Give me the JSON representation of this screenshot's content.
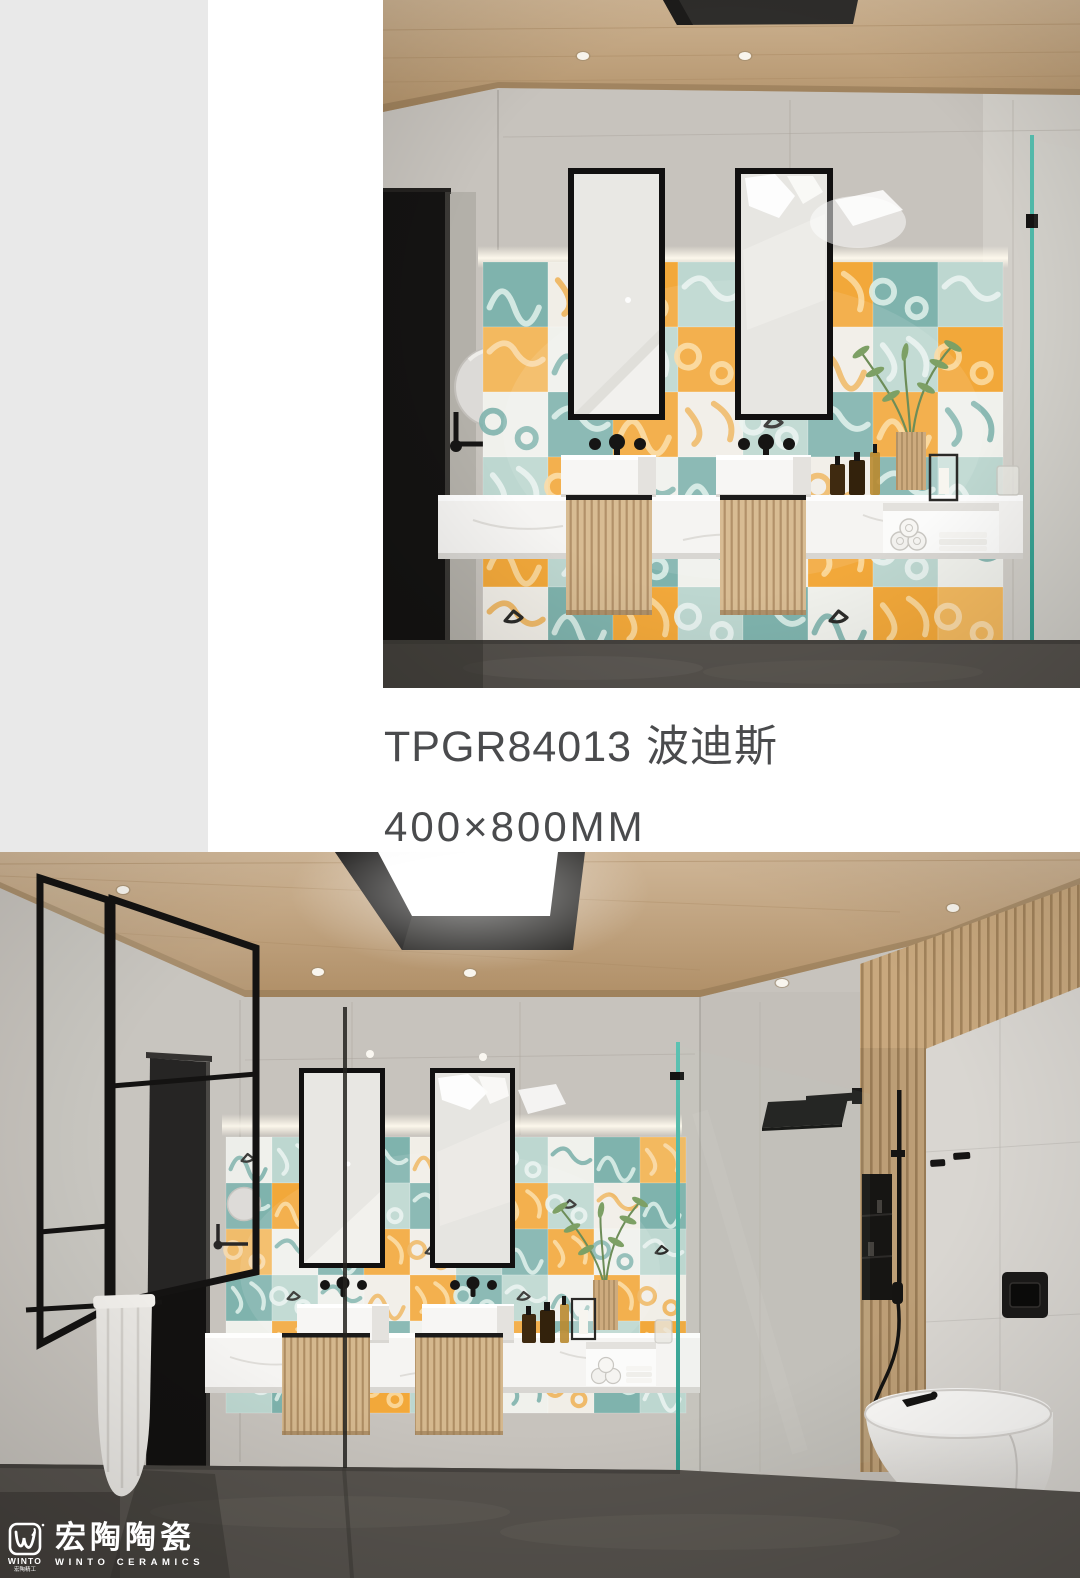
{
  "page": {
    "background": "#ffffff",
    "left_strip_color": "#e9e9e9"
  },
  "product": {
    "code": "TPGR84013",
    "name": "波迪斯",
    "size": "400×800MM",
    "text_color": "#4a4b4d"
  },
  "brand": {
    "logo_chinese": "宏陶陶瓷",
    "logo_english": "WINTO CERAMICS",
    "emblem_word": "WINTO",
    "emblem_sub": "宏陶精工",
    "logo_color": "#ffffff"
  },
  "photos": {
    "top": {
      "label": "bathroom render: double vanity with patchwork tile feature wall"
    },
    "bottom": {
      "label": "bathroom render: wide view with vanity, shower and wall-hung toilet"
    }
  },
  "palette": {
    "tile_orange": "#f2a83a",
    "tile_orange_pale": "#f3b95f",
    "tile_teal": "#7fb3ad",
    "tile_teal_pale": "#bdd7d0",
    "tile_white": "#f0f1ec",
    "wood": "#c7a47e",
    "wall": "#c7c3bd",
    "wall_bright": "#d9d6d1",
    "floor": "#56524d",
    "counter": "#f5f4f2",
    "glass": "#44b0a0",
    "fixture_black": "#161514"
  }
}
